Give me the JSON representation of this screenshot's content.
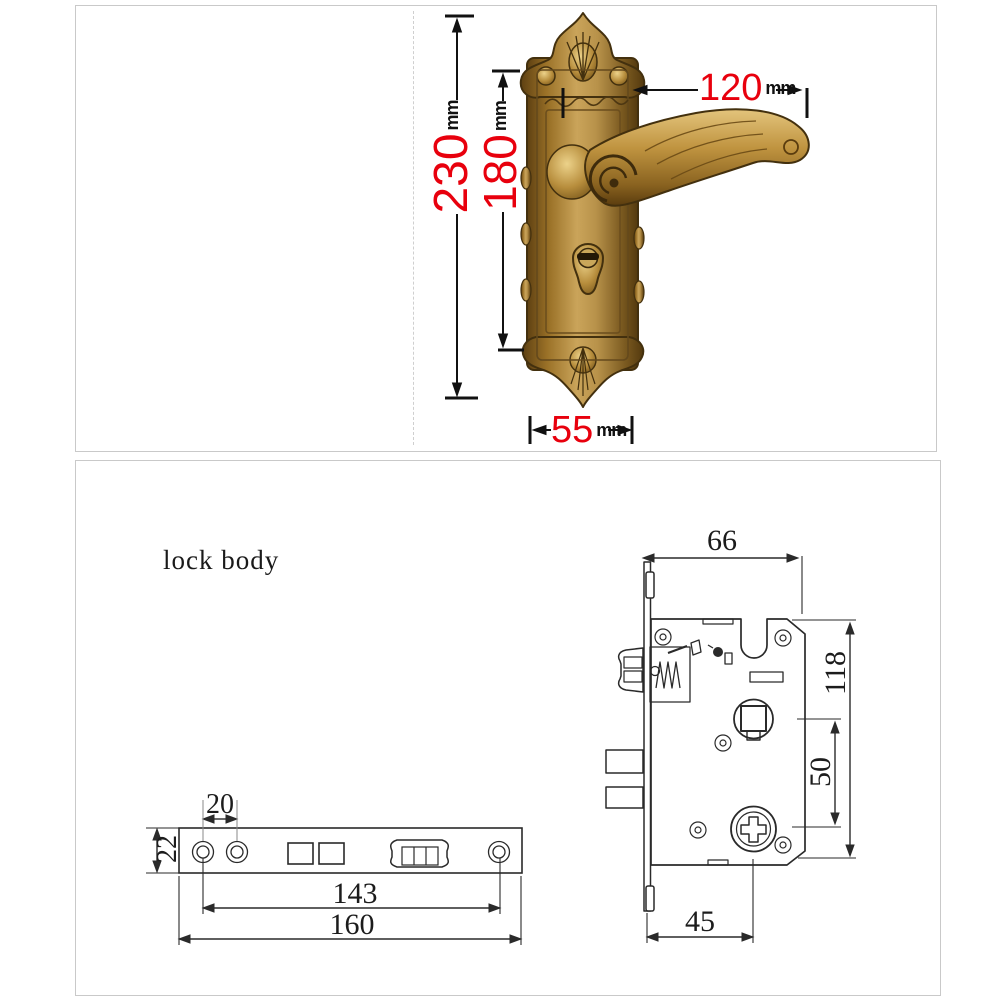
{
  "top_panel": {
    "dim_total_height": {
      "num": "230",
      "unit": "mm"
    },
    "dim_plate_height": {
      "num": "180",
      "unit": "mm"
    },
    "dim_handle_length": {
      "num": "120",
      "unit": "mm"
    },
    "dim_plate_width": {
      "num": "55",
      "unit": "mm"
    }
  },
  "bottom_panel": {
    "title": "lock body",
    "dim_case_width": "66",
    "dim_case_height": "118",
    "dim_spindle_to_cylinder": "50",
    "dim_backset": "45",
    "dim_screw_gap": "20",
    "dim_faceplate_width": "22",
    "dim_screw_span": "143",
    "dim_faceplate_length": "160"
  },
  "colors": {
    "dimension_red": "#e8000d",
    "line_ink": "#2a2a2a",
    "panel_border": "#c9c9c9",
    "brass_light": "#d8b467",
    "brass_mid": "#a87c33",
    "brass_dark": "#5f3f12"
  }
}
